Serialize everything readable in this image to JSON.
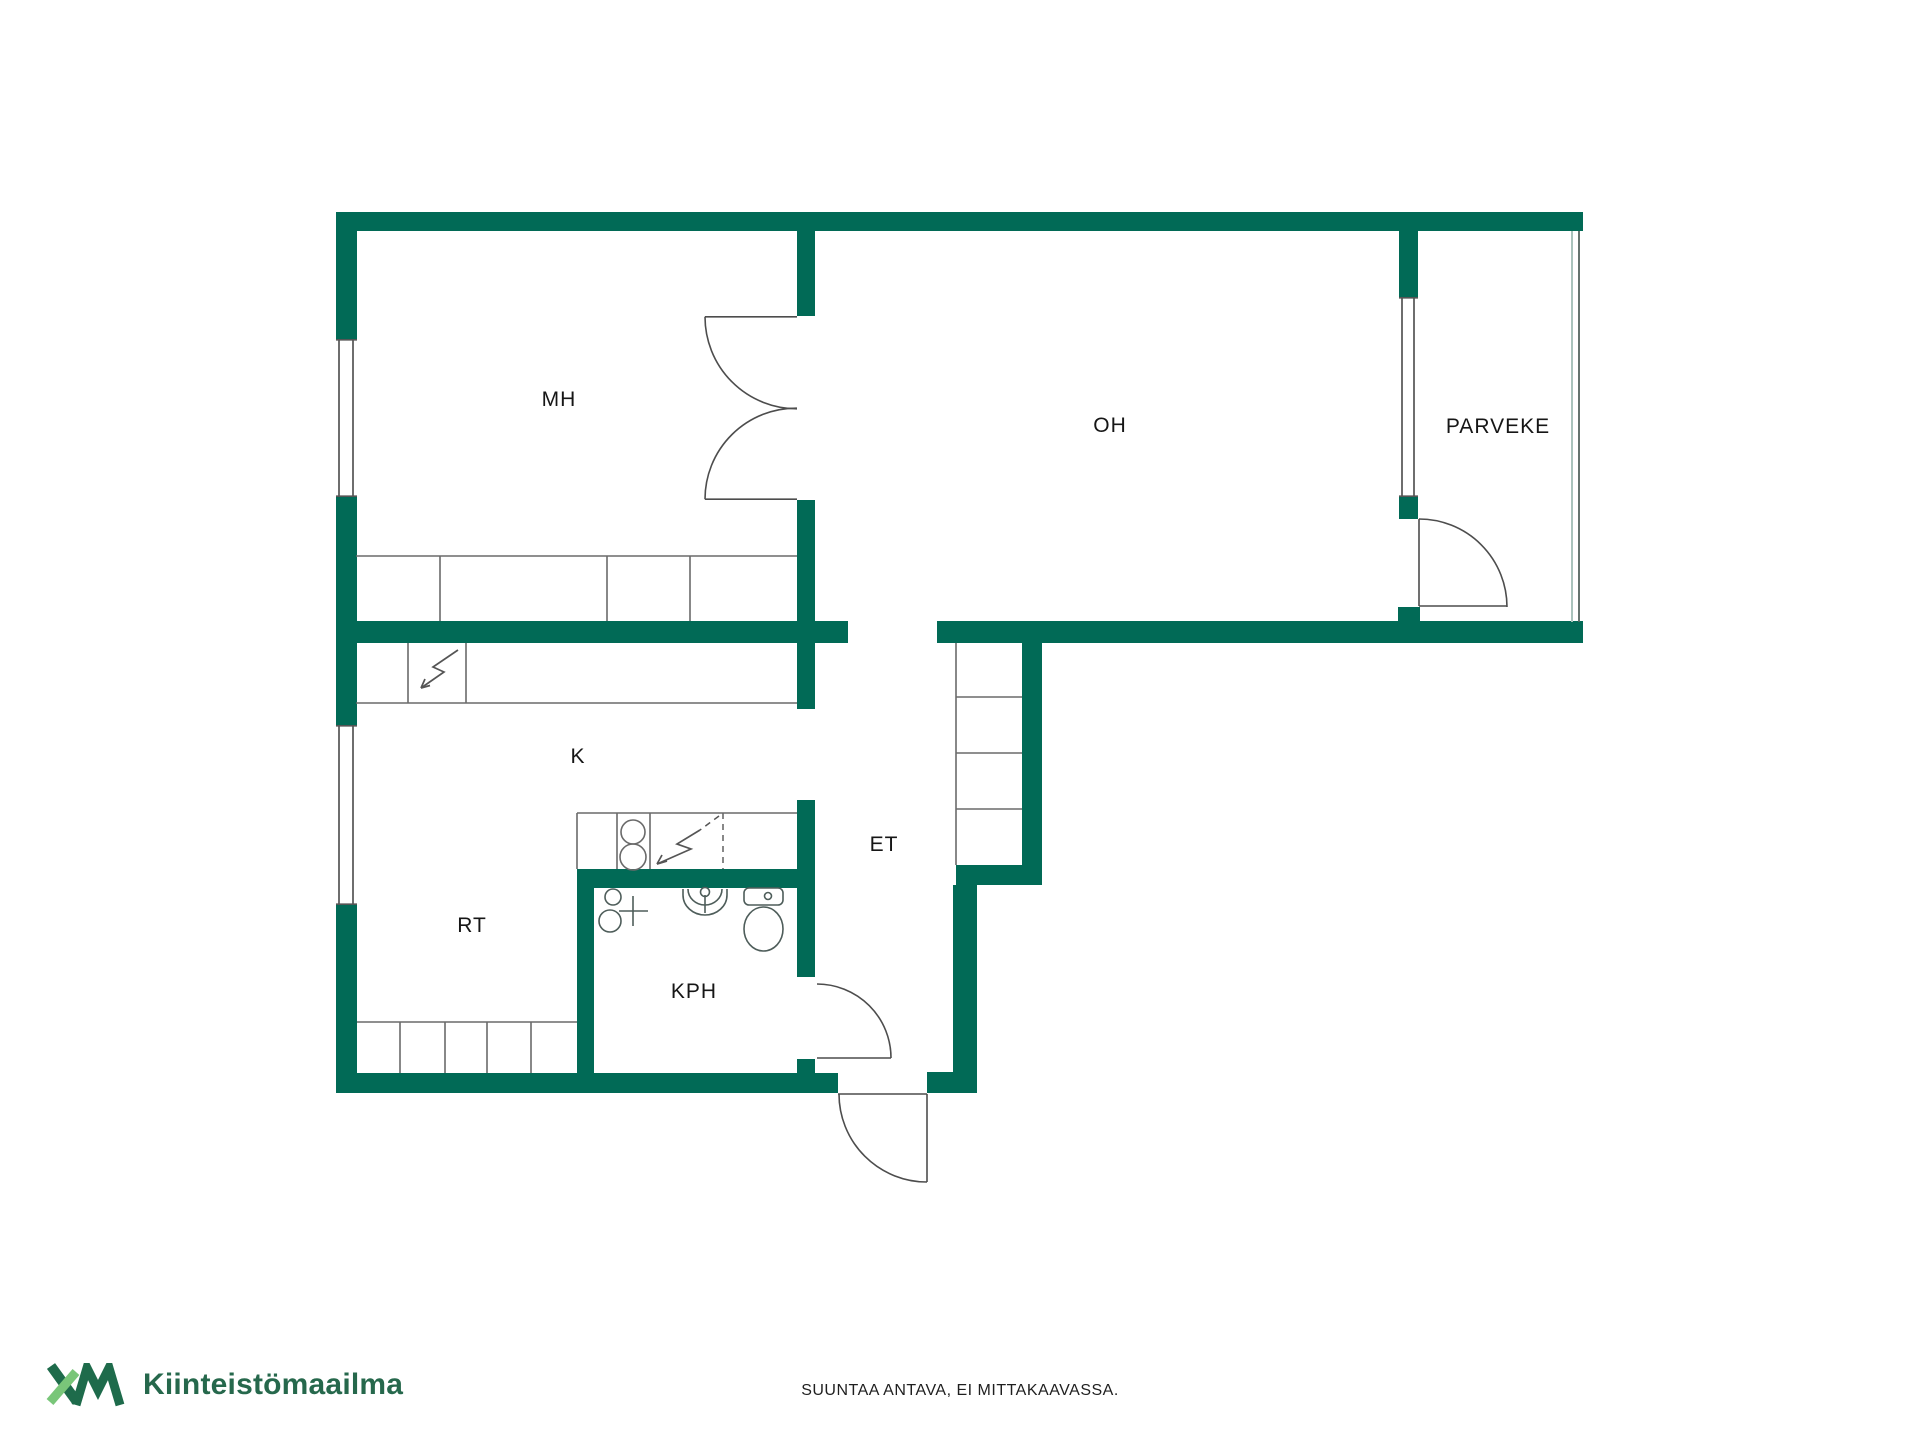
{
  "floorplan": {
    "wall_color": "#016a56",
    "line_color": "#5f6b68",
    "rooms": [
      {
        "id": "mh",
        "label": "MH"
      },
      {
        "id": "oh",
        "label": "OH"
      },
      {
        "id": "parveke",
        "label": "PARVEKE"
      },
      {
        "id": "k",
        "label": "K"
      },
      {
        "id": "et",
        "label": "ET"
      },
      {
        "id": "rt",
        "label": "RT"
      },
      {
        "id": "kph",
        "label": "KPH"
      }
    ]
  },
  "footer": {
    "brand_name": "Kiinteistömaailma",
    "brand_logo": "km-monogram",
    "logo_dark": "#1e6b4b",
    "logo_light": "#79c679",
    "brand_text_color": "#26684c",
    "disclaimer": "SUUNTAA ANTAVA, EI MITTAKAAVASSA."
  }
}
